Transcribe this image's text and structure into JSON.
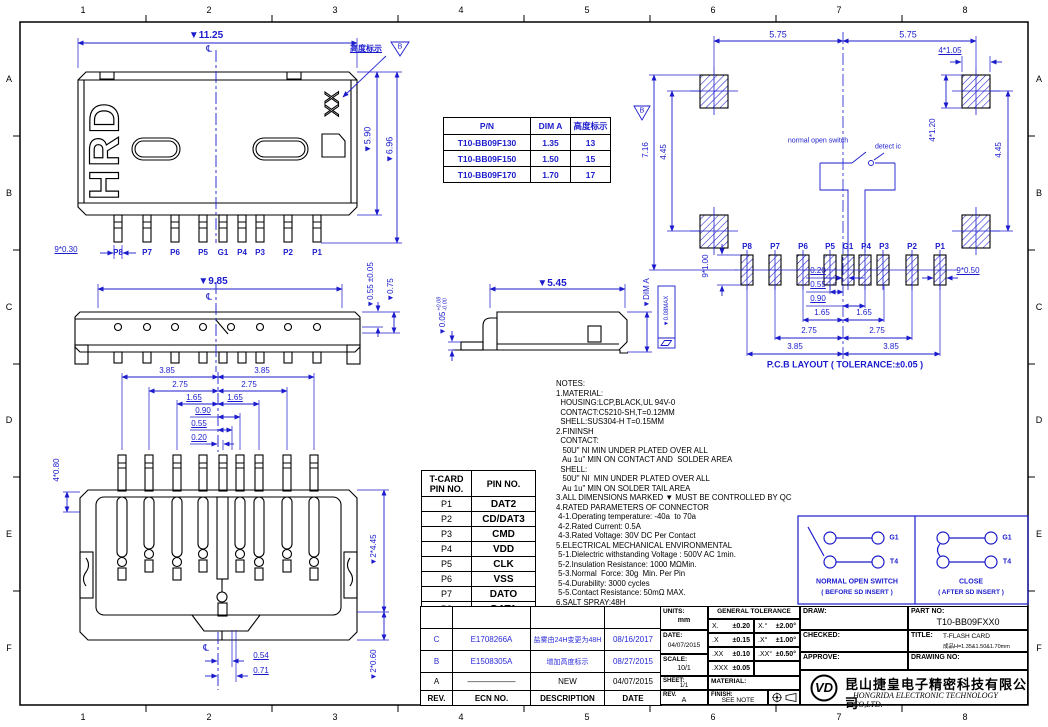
{
  "colors": {
    "dimension_blue": "#1b1bcd",
    "line_black": "#000000"
  },
  "drawing": {
    "zones": {
      "columns": [
        "1",
        "2",
        "3",
        "4",
        "5",
        "6",
        "7",
        "8"
      ],
      "rows": [
        "A",
        "B",
        "C",
        "D",
        "E",
        "F"
      ]
    }
  },
  "front_view": {
    "dim_width": "▼11.25",
    "centerline": "℄",
    "height_callout": "高度标示",
    "height_flag": "B",
    "shell_mark": "HRD",
    "height_mark": "XX",
    "dim_shell_height": "▼5.90",
    "dim_total_height": "▼6.96",
    "dim_pin_width": "9*0.30",
    "pins": [
      "P8",
      "P7",
      "P6",
      "P5",
      "G1",
      "P4",
      "P3",
      "P2",
      "P1"
    ]
  },
  "pn_table": {
    "headers": [
      "P/N",
      "DIM A",
      "高度标示"
    ],
    "flag": "B",
    "rows": [
      {
        "pn": "T10-BB09F130",
        "dim_a": "1.35",
        "height": "13"
      },
      {
        "pn": "T10-BB09F150",
        "dim_a": "1.50",
        "height": "15"
      },
      {
        "pn": "T10-BB09F170",
        "dim_a": "1.70",
        "height": "17"
      }
    ]
  },
  "pcb_layout": {
    "dim_left": "5.75",
    "dim_right": "5.75",
    "dim_pad_width": "4*1.05",
    "dim_pad_height": "4*1.20",
    "dim_side_left": "4.45",
    "dim_side_right": "4.45",
    "dim_total_height": "7.16",
    "switch_label": "normal open switch",
    "detect_label": "detect ic",
    "pads": [
      "P8",
      "P7",
      "P6",
      "P5",
      "G1",
      "P4",
      "P3",
      "P2",
      "P1"
    ],
    "dim_pin_height": "9*1.00",
    "dim_pin_width": "9*0.50",
    "stack": [
      "0.20",
      "0.55",
      "0.90",
      "1.65",
      "1.65",
      "2.75",
      "2.75",
      "3.85",
      "3.85"
    ],
    "caption": "P.C.B LAYOUT ( TOLERANCE:±0.05 )"
  },
  "top_view": {
    "dim_width": "▼9.85",
    "centerline": "℄",
    "dim_contact": "▼0.55 ±0.05",
    "dim_shell": "▼0.75"
  },
  "side_view": {
    "dim_width": "▼5.45",
    "dim_a": "▼DIM A",
    "dim_standoff": "▼0.05",
    "tol_up": "+0.08",
    "tol_dn": "-0.00",
    "flatness": "▼0.08MAX"
  },
  "bottom_view": {
    "stack": [
      "3.85",
      "3.85",
      "2.75",
      "2.75",
      "1.65",
      "1.65",
      "0.90",
      "0.55",
      "0.20"
    ],
    "dim_latch": "4*0.80",
    "dim_body": "▼2*4.45",
    "dim_tail": "▼2*0.60",
    "dim_c1": "0.54",
    "dim_c2": "0.71",
    "centerline": "℄"
  },
  "notes": {
    "lines": [
      "NOTES:",
      "1.MATERIAL:",
      "  HOUSING:LCP,BLACK,UL 94V-0",
      "  CONTACT:C5210-SH,T=0.12MM",
      "  SHELL:SUS304-H T=0.15MM",
      "2.FININSH",
      "  CONTACT:",
      "   50U\" NI MIN UNDER PLATED OVER ALL",
      "   Au 1u\" MIN ON CONTACT AND  SOLDER AREA",
      "  SHELL:",
      "   50U\" NI  MIN UNDER PLATED OVER ALL",
      "   Au 1u\" MIN ON SOLDER TAIL AREA",
      "3.ALL DIMENSIONS MARKED ▼ MUST BE CONTROLLED BY QC",
      "4.RATED PARAMETERS OF CONNECTOR",
      " 4-1.Operating temperature: -40a  to 70a",
      " 4-2.Rated Current: 0.5A",
      " 4-3.Rated Voltage: 30V DC Per Contact",
      "5.ELECTRICAL MECHANICAL ENVIRONMENTAL",
      " 5-1.Dielectric withstanding Voltage : 500V AC 1min.",
      " 5-2.Insulation Resistance: 1000 MΩMin.",
      " 5-3.Normal  Force: 30g  Min. Per Pin",
      " 5-4.Durability: 3000 cycles",
      " 5-5.Contact Resistance: 50mΩ MAX.",
      "6.SALT SPRAY:48H"
    ]
  },
  "pin_table": {
    "header_col1_l1": "T-CARD",
    "header_col1_l2": "PIN NO.",
    "header_col2": "PIN NO.",
    "rows": [
      {
        "pin": "P1",
        "signal": "DAT2"
      },
      {
        "pin": "P2",
        "signal": "CD/DAT3"
      },
      {
        "pin": "P3",
        "signal": "CMD"
      },
      {
        "pin": "P4",
        "signal": "VDD"
      },
      {
        "pin": "P5",
        "signal": "CLK"
      },
      {
        "pin": "P6",
        "signal": "VSS"
      },
      {
        "pin": "P7",
        "signal": "DATO"
      },
      {
        "pin": "P8",
        "signal": "DAT1"
      },
      {
        "pin": "G1",
        "signal": "SWITCH"
      }
    ]
  },
  "switch_diagrams": {
    "open": {
      "title": "NORMAL OPEN SWITCH",
      "subtitle": "( BEFORE SD INSERT )",
      "t1": "G1",
      "t2": "T4"
    },
    "close": {
      "title": "CLOSE",
      "subtitle": "( AFTER SD INSERT )",
      "t1": "G1",
      "t2": "T4"
    }
  },
  "title_block": {
    "revisions": [
      {
        "rev": "C",
        "ecn": "E1708266A",
        "desc": "盐雾由24H变更为48H",
        "date": "08/16/2017"
      },
      {
        "rev": "B",
        "ecn": "E1508305A",
        "desc": "增加高度标示",
        "date": "08/27/2015"
      },
      {
        "rev": "A",
        "ecn": "——————",
        "desc": "NEW",
        "date": "04/07/2015"
      }
    ],
    "rev_headers": {
      "rev": "REV.",
      "ecn": "ECN NO.",
      "desc": "DESCRIPTION",
      "date": "DATE"
    },
    "units_label": "UNITS:",
    "units_value": "mm",
    "date_label": "DATE:",
    "date_value": "04/07/2015",
    "scale_label": "SCALE:",
    "scale_value": "10/1",
    "sheet_label": "SHEET:",
    "sheet_value": "1/1",
    "rev_label": "REV.",
    "rev_value": "A",
    "tolerance": {
      "title": "GENERAL TOLERANCE",
      "linear": [
        {
          "k": "X.",
          "v": "±0.20"
        },
        {
          "k": ".X",
          "v": "±0.15"
        },
        {
          "k": ".XX",
          "v": "±0.10"
        },
        {
          "k": ".XXX",
          "v": "±0.05"
        }
      ],
      "angular": [
        {
          "k": "X.°",
          "v": "±2.00°"
        },
        {
          "k": ".X°",
          "v": "±1.00°"
        },
        {
          "k": ".XX°",
          "v": "±0.50°"
        }
      ]
    },
    "material_label": "MATERIAL:",
    "finish_label": "FINISH:",
    "finish_value": "SEE NOTE",
    "draw_label": "DRAW:",
    "checked_label": "CHECKED:",
    "approve_label": "APPROVE:",
    "part_label": "PART NO:",
    "part_value": "T10-BB09FXX0",
    "title_label": "TITLE:",
    "title_value": "T-FLASH CARD",
    "title_value2": "成品H=1.35&1.50&1.70mm",
    "drawing_no_label": "DRAWING NO:",
    "logo_text": "VD",
    "company_cn": "昆山捷皇电子精密科技有限公司",
    "company_en": "HONGRIDA ELECTRONIC TECHNOLOGY CO,LTD."
  }
}
